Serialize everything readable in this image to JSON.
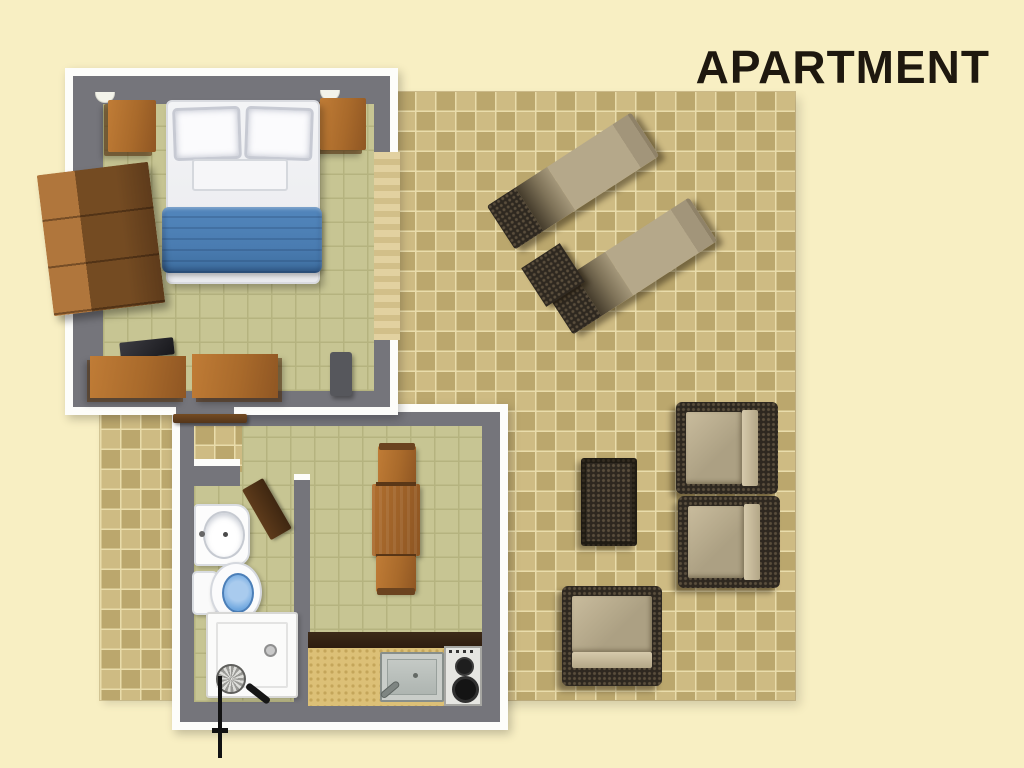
{
  "title": "APARTMENT",
  "palette": {
    "bg": "#F8EFC3",
    "title": "#1E180F",
    "wall": "#75757B",
    "white-wall": "#FDFDFA",
    "floor-green": "#C7C593",
    "grout-green": "#B5B37F",
    "tile-a": "#CEBB83",
    "tile-b": "#BBA76D",
    "grout-tan": "#E9DCAB",
    "wood": "#A96A2B",
    "wood-light": "#C07C36",
    "wood-dark": "#744B22",
    "wood-deep": "#54351A",
    "wicker": "#2E2820",
    "wicker-dot": "#5A4E3C",
    "cushion": "#ACA083",
    "cushion-light": "#C9BC9D",
    "deck": "#B5A88A",
    "blanket": "#4A7CB1",
    "counter-face": "#DCC077",
    "counter-top": "#2E1D0F",
    "toilet-blue": "#6FA7DF"
  },
  "rooms": [
    "bedroom",
    "bathroom",
    "kitchen-living-room",
    "terrace"
  ],
  "furniture": {
    "bedroom": [
      "double-bed",
      "pillows",
      "blue-blanket",
      "nightstand-left",
      "nightstand-right",
      "wardrobe",
      "tv",
      "desk",
      "bench",
      "chair",
      "wall-lamps",
      "terrace-door-threshold",
      "open-entry-door"
    ],
    "bathroom": [
      "washbasin",
      "toilet",
      "shower-tray",
      "shower-head",
      "bathroom-door"
    ],
    "kitchen_living": [
      "dining-table",
      "dining-chair-top",
      "dining-chair-bottom",
      "kitchen-counter",
      "kitchen-sink",
      "two-burner-stove"
    ],
    "terrace": [
      "sun-lounger",
      "sun-lounger",
      "wicker-side-table",
      "wicker-coffee-table",
      "wicker-armchair",
      "wicker-armchair",
      "wicker-armchair"
    ]
  }
}
